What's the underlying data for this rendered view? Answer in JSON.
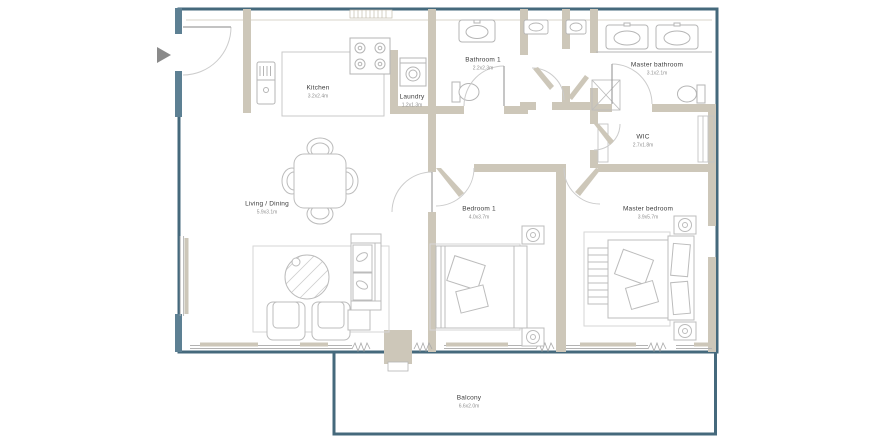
{
  "plan": {
    "kind": "apartment-floor-plan",
    "rooms": [
      {
        "id": "kitchen",
        "label": "Kitchen",
        "dims": "3.2x2.4m"
      },
      {
        "id": "laundry",
        "label": "Laundry",
        "dims": "1.2x1.3m"
      },
      {
        "id": "bathroom-1",
        "label": "Bathroom 1",
        "dims": "2.2x2.3m"
      },
      {
        "id": "master-bathroom",
        "label": "Master bathroom",
        "dims": "3.1x2.1m"
      },
      {
        "id": "wic",
        "label": "WIC",
        "dims": "2.7x1.8m"
      },
      {
        "id": "living-dining",
        "label": "Living / Dining",
        "dims": "5.9x3.1m"
      },
      {
        "id": "bedroom-1",
        "label": "Bedroom 1",
        "dims": "4.0x3.7m"
      },
      {
        "id": "master-bedroom",
        "label": "Master bedroom",
        "dims": "3.9x5.7m"
      },
      {
        "id": "balcony",
        "label": "Balcony",
        "dims": "6.6x2.0m"
      }
    ],
    "entrance_marker_icon": "right-triangle-arrow",
    "colors": {
      "outer_wall": "#45697c",
      "interior_wall": "#cdc7b9",
      "wall_accent": "#5d8093",
      "furniture_line": "#bcbcbc",
      "label_text": "#3d3d3d",
      "dimension_text": "#909090",
      "background": "#ffffff"
    }
  }
}
